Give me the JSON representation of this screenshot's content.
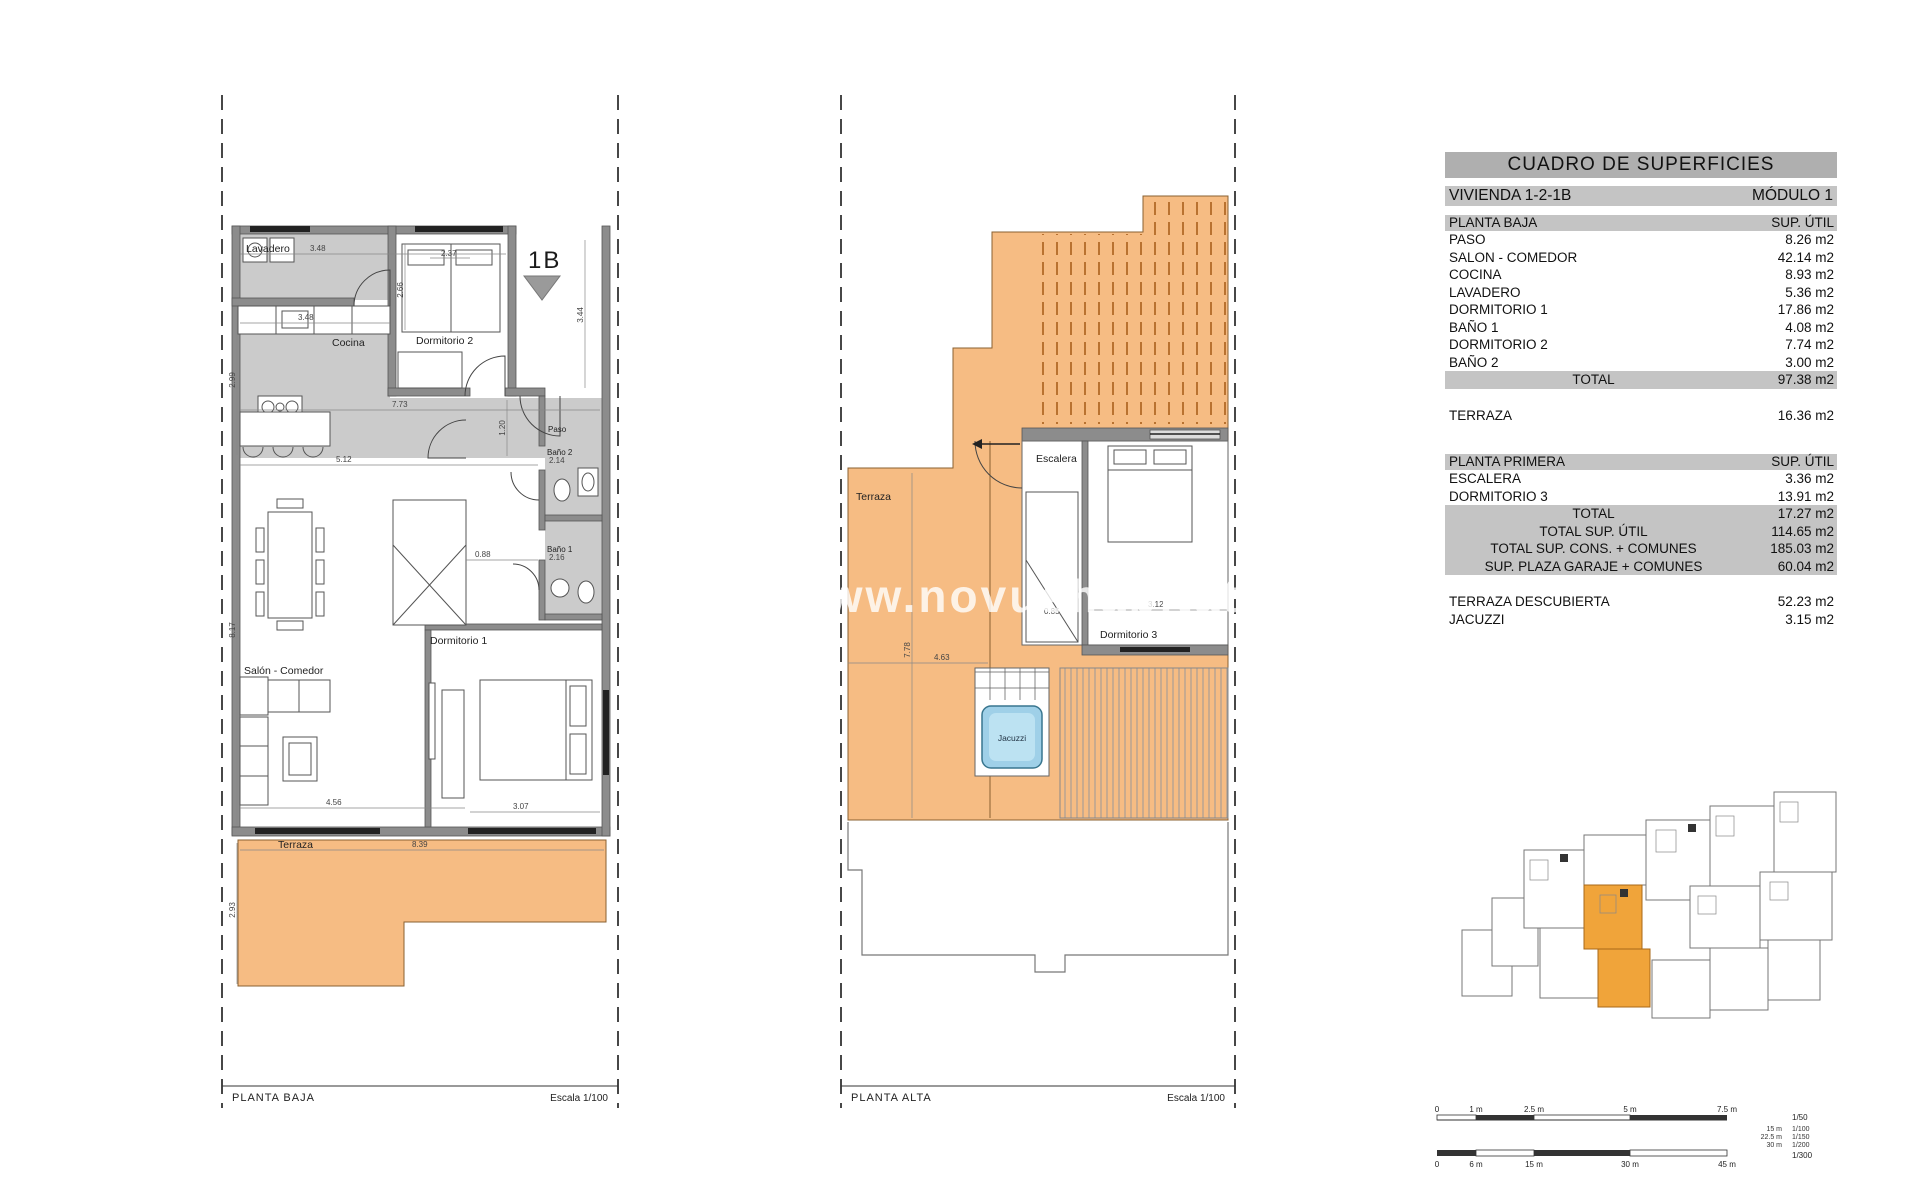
{
  "watermark": {
    "text": "www.novushabitat"
  },
  "colors": {
    "terrace_orange": "#F6BC83",
    "hatch_orange": "#B97230",
    "highlight_unit_orange": "#F0A43A",
    "jacuzzi_blue": "#9FD0E8",
    "table_header_gray": "#AFAFAF",
    "table_bar_gray": "#C4C4C4",
    "wall_gray": "#8C8C8C"
  },
  "table": {
    "title": "CUADRO DE SUPERFICIES",
    "header": {
      "left": "VIVIENDA 1-2-1B",
      "right": "MÓDULO 1"
    },
    "s1": {
      "head": {
        "left": "PLANTA BAJA",
        "right": "SUP. ÚTIL"
      },
      "rows": [
        {
          "l": "PASO",
          "v": "8.26 m2"
        },
        {
          "l": "SALON - COMEDOR",
          "v": "42.14 m2"
        },
        {
          "l": "COCINA",
          "v": "8.93 m2"
        },
        {
          "l": "LAVADERO",
          "v": "5.36 m2"
        },
        {
          "l": "DORMITORIO 1",
          "v": "17.86 m2"
        },
        {
          "l": "BAÑO 1",
          "v": "4.08 m2"
        },
        {
          "l": "DORMITORIO 2",
          "v": "7.74 m2"
        },
        {
          "l": "BAÑO 2",
          "v": "3.00 m2"
        }
      ],
      "total": {
        "l": "TOTAL",
        "v": "97.38 m2"
      }
    },
    "terraza": {
      "l": "TERRAZA",
      "v": "16.36 m2"
    },
    "s2": {
      "head": {
        "left": "PLANTA PRIMERA",
        "right": "SUP. ÚTIL"
      },
      "rows": [
        {
          "l": "ESCALERA",
          "v": "3.36 m2"
        },
        {
          "l": "DORMITORIO 3",
          "v": "13.91 m2"
        }
      ],
      "totals": [
        {
          "l": "TOTAL",
          "v": "17.27 m2"
        },
        {
          "l": "TOTAL SUP. ÚTIL",
          "v": "114.65 m2"
        },
        {
          "l": "TOTAL SUP. CONS. + COMUNES",
          "v": "185.03 m2"
        },
        {
          "l": "SUP. PLAZA GARAJE + COMUNES",
          "v": "60.04 m2"
        }
      ]
    },
    "extra": [
      {
        "l": "TERRAZA DESCUBIERTA",
        "v": "52.23 m2"
      },
      {
        "l": "JACUZZI",
        "v": "3.15 m2"
      }
    ]
  },
  "plans": {
    "baja": {
      "title": "PLANTA BAJA",
      "scale": "Escala 1/100",
      "marker": "1B",
      "rooms": {
        "lavadero": "Lavadero",
        "cocina": "Cocina",
        "dorm2": "Dormitorio 2",
        "paso": "Paso",
        "bano2": "Baño 2",
        "bano1": "Baño 1",
        "dorm1": "Dormitorio 1",
        "salon": "Salón - Comedor",
        "terraza": "Terraza"
      },
      "dims": {
        "a": "3.48",
        "b": "2.37",
        "c": "2.66",
        "d": "3.48",
        "e": "2.99",
        "f": "7.73",
        "g": "1.20",
        "h": "3.44",
        "i": "5.12",
        "j": "0.88",
        "k": "2.14",
        "l": "2.16",
        "m": "8.17",
        "n": "4.56",
        "o": "3.07",
        "p": "8.39",
        "q": "2.93"
      }
    },
    "alta": {
      "title": "PLANTA ALTA",
      "scale": "Escala 1/100",
      "rooms": {
        "terraza": "Terraza",
        "escalera": "Escalera",
        "dorm3": "Dormitorio 3",
        "jacuzzi": "Jacuzzi"
      },
      "dims": {
        "a": "7.78",
        "b": "4.63",
        "c": "3.12",
        "d": "0.85"
      }
    }
  },
  "scalebar": {
    "r50": {
      "t0": "0",
      "t1": "1 m",
      "t2": "2.5 m",
      "t3": "5 m",
      "t4": "7.5 m",
      "scale": "1/50"
    },
    "mids": [
      {
        "len": "15 m",
        "scale": "1/100"
      },
      {
        "len": "22.5 m",
        "scale": "1/150"
      },
      {
        "len": "30 m",
        "scale": "1/200"
      }
    ],
    "r300": {
      "t0": "0",
      "t1": "6 m",
      "t2": "15 m",
      "t3": "30 m",
      "t4": "45 m",
      "scale": "1/300"
    }
  }
}
